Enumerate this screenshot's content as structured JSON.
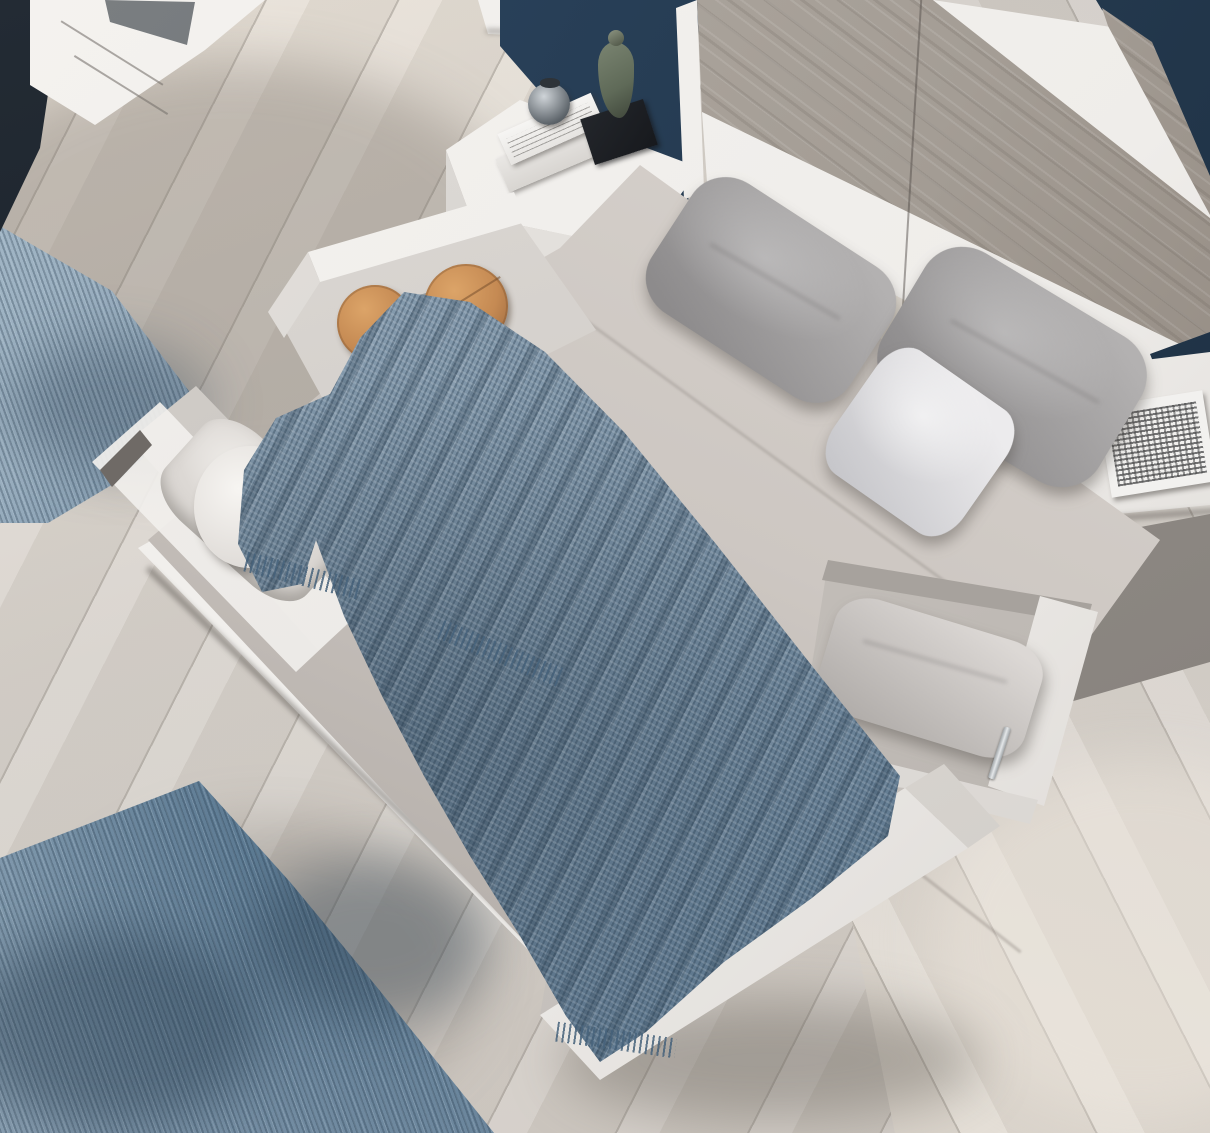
{
  "meta": {
    "image_type": "photograph",
    "view": "overhead view of a modern bedroom",
    "visible_text": "none"
  },
  "palette": {
    "floor": "#d6d1cb",
    "floor_light": "#e9e2d8",
    "rug": "#7e95a9",
    "rug_dark": "#50708a",
    "rug_light": "#a6bac9",
    "navy": "#24394e",
    "navy_dark": "#10161d",
    "white_furn": "#efedea",
    "white_dim": "#d9d5d1",
    "hb_gray": "#a49d95",
    "hb_gray_dark": "#897f76",
    "sheet": "#cdc7c2",
    "sheet_dark": "#a8a29d",
    "pillow": "#b3b1b1",
    "pillow_dark": "#8d8b8c",
    "pillow_white": "#ecebed",
    "throw": "#7d93a6",
    "throw_dark": "#46627b",
    "purple": "#48404a",
    "purple_dark": "#2e2930",
    "wood_box": "#c58a53",
    "wood_box_dark": "#95623a",
    "figurine": "#5f6a58",
    "black": "#17191d"
  },
  "scene": {
    "floor": {
      "material": "pale chevron wood planks"
    },
    "rug": {
      "color_key": "rug",
      "position": "left side, partially under bed"
    },
    "bed": {
      "orientation": "diagonal, head at upper right",
      "headboard": {
        "bands": [
          "white",
          "gray wood",
          "white",
          "gray wood"
        ],
        "wall_color_key": "navy"
      },
      "sheet_color_key": "sheet",
      "pillow_count": 3,
      "pillows": [
        "gray",
        "gray",
        "white"
      ],
      "knit_throw_color_key": "throw"
    },
    "storage_drawers": [
      {
        "id": "head-left",
        "contents": "two round wooden boxes"
      },
      {
        "id": "side-left",
        "contents": "white linen"
      },
      {
        "id": "side-right",
        "contents": "gray pillow"
      },
      {
        "id": "foot-right",
        "contents": "dark purple fringed throw"
      }
    ],
    "nightstand_left": {
      "props": [
        "stack of two books",
        "glass jar",
        "figurine on black base"
      ]
    },
    "nightstand_right": {
      "props": [
        "black and white comic book"
      ]
    },
    "dresser": {
      "position": "top left corner",
      "color": "white with dark inset"
    },
    "side_stool": {
      "shape": "round",
      "color": "white"
    }
  }
}
